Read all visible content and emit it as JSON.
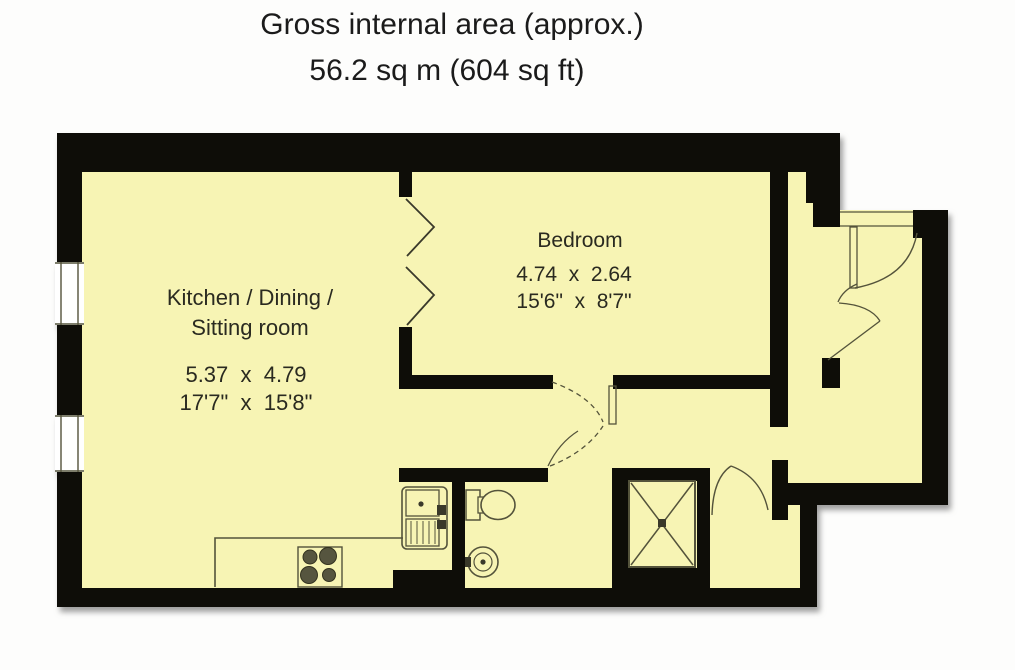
{
  "title": {
    "line1": "Gross internal area (approx.)",
    "line2": "56.2 sq m (604 sq ft)"
  },
  "rooms": {
    "kitchen": {
      "name_line1": "Kitchen / Dining /",
      "name_line2": "Sitting room",
      "dims_metric": "5.37  x  4.79",
      "dims_imperial": "17'7\"  x  15'8\""
    },
    "bedroom": {
      "name": "Bedroom",
      "dims_metric": "4.74  x  2.64",
      "dims_imperial": "15'6\"  x  8'7\""
    }
  },
  "colors": {
    "floor": "#f7f4b4",
    "wall": "#0e0d08",
    "line": "#54533b",
    "dark": "#3a392a",
    "text": "#2a2a20",
    "title": "#1b1b1b"
  }
}
